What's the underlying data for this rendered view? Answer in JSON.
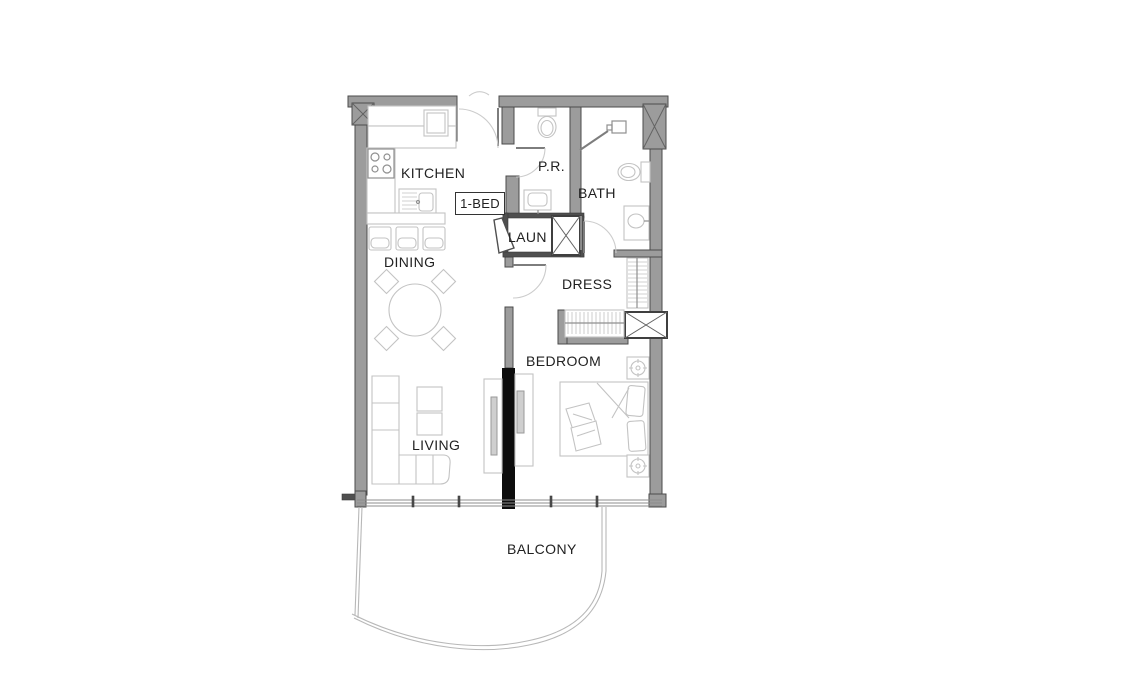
{
  "plan": {
    "unit_tag": "1-BED",
    "rooms": {
      "kitchen": "KITCHEN",
      "powder_room": "P.R.",
      "bath": "BATH",
      "laundry": "LAUN",
      "dining": "DINING",
      "dress": "DRESS",
      "bedroom": "BEDROOM",
      "living": "LIVING",
      "balcony": "BALCONY"
    },
    "colors": {
      "wall_fill": "#9c9c9c",
      "wall_stroke": "#4b4b4b",
      "accent_wall": "#0d0d0d",
      "fixture_line": "#c3c3c3",
      "fixture_line_dark": "#8f8f8f",
      "label_text": "#212121",
      "background": "#ffffff"
    }
  }
}
